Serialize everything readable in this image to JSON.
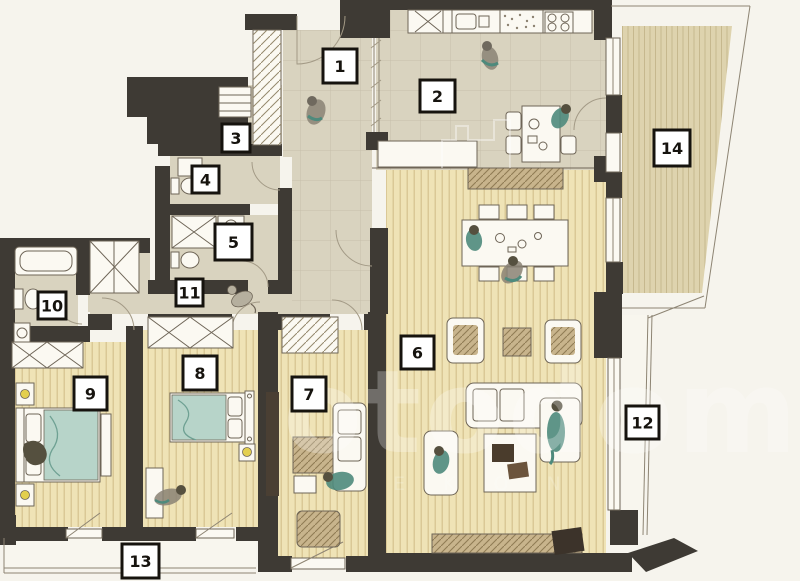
{
  "page": {
    "background": "#f6f4ed"
  },
  "plan": {
    "watermark": {
      "text": "otodom",
      "subtext": "E K O N"
    },
    "colors": {
      "wall": "#3e3a34",
      "floorGrey": "#d9d3bf",
      "floorWood": "#efe3b6",
      "woodStripe": "#d5c28f",
      "deck": "#ded3ae",
      "deckStripe": "#c6b88e",
      "outline": "#6e6557",
      "tan": "#c8b48c",
      "tanDark": "#907c55",
      "teal": "#4e8a7c",
      "tealLight": "#b7d4c9",
      "lamp": "#e3cf4e",
      "white": "#fbf9f2",
      "background": "#f6f4ed",
      "labelInk": "#16130e"
    },
    "labels": [
      {
        "number": "1",
        "x": 323,
        "y": 49,
        "w": 34,
        "h": 34
      },
      {
        "number": "2",
        "x": 420,
        "y": 80,
        "w": 35,
        "h": 32
      },
      {
        "number": "3",
        "x": 222,
        "y": 124,
        "w": 28,
        "h": 28
      },
      {
        "number": "4",
        "x": 192,
        "y": 166,
        "w": 27,
        "h": 27
      },
      {
        "number": "5",
        "x": 215,
        "y": 224,
        "w": 37,
        "h": 36
      },
      {
        "number": "6",
        "x": 401,
        "y": 336,
        "w": 33,
        "h": 33
      },
      {
        "number": "7",
        "x": 292,
        "y": 377,
        "w": 34,
        "h": 34
      },
      {
        "number": "8",
        "x": 183,
        "y": 356,
        "w": 34,
        "h": 34
      },
      {
        "number": "9",
        "x": 74,
        "y": 377,
        "w": 33,
        "h": 33
      },
      {
        "number": "10",
        "x": 38,
        "y": 292,
        "w": 28,
        "h": 27
      },
      {
        "number": "11",
        "x": 176,
        "y": 279,
        "w": 27,
        "h": 27
      },
      {
        "number": "12",
        "x": 626,
        "y": 406,
        "w": 33,
        "h": 33
      },
      {
        "number": "13",
        "x": 122,
        "y": 544,
        "w": 37,
        "h": 34
      },
      {
        "number": "14",
        "x": 654,
        "y": 130,
        "w": 36,
        "h": 36
      }
    ]
  }
}
